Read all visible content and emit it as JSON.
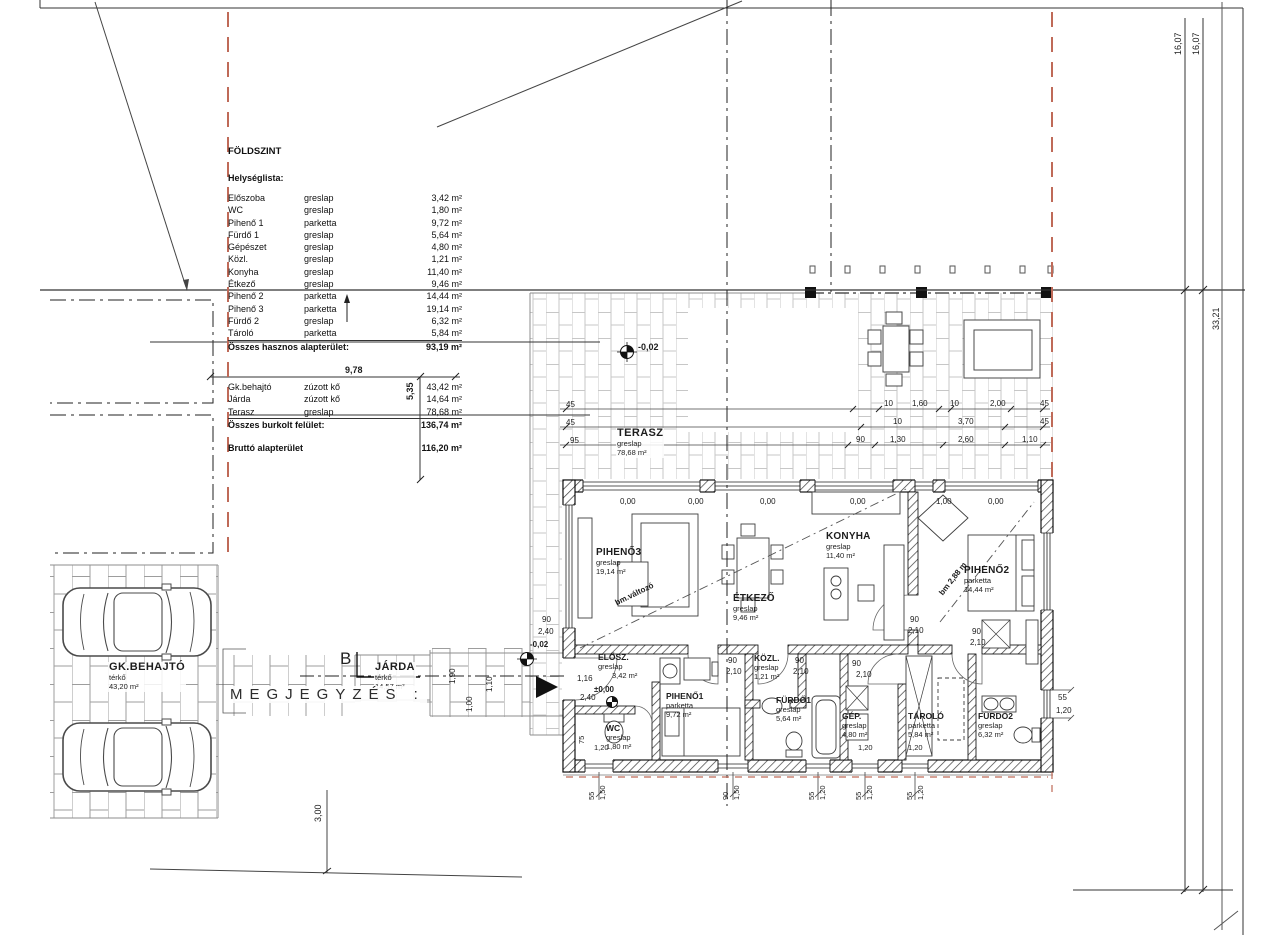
{
  "titleblock": {
    "title": "FÖLDSZINT",
    "list_heading": "Helységlista:",
    "rooms": [
      [
        "Előszoba",
        "greslap",
        "3,42 m²"
      ],
      [
        "WC",
        "greslap",
        "1,80 m²"
      ],
      [
        "Pihenő 1",
        "parketta",
        "9,72 m²"
      ],
      [
        "Fürdő 1",
        "greslap",
        "5,64 m²"
      ],
      [
        "Gépészet",
        "greslap",
        "4,80 m²"
      ],
      [
        "Közl.",
        "greslap",
        "1,21 m²"
      ],
      [
        "Konyha",
        "greslap",
        "11,40 m²"
      ],
      [
        "Étkező",
        "greslap",
        "9,46 m²"
      ],
      [
        "Pihenő 2",
        "parketta",
        "14,44 m²"
      ],
      [
        "Pihenő 3",
        "parketta",
        "19,14 m²"
      ],
      [
        "Fürdő 2",
        "greslap",
        "6,32 m²"
      ],
      [
        "Tároló",
        "parketta",
        "5,84 m²"
      ]
    ],
    "room_total_label": "Összes hasznos alapterület:",
    "room_total": "93,19 m²",
    "site_rows": [
      [
        "Gk.behajtó",
        "zúzott kő",
        "43,42 m²"
      ],
      [
        "Járda",
        "zúzott kő",
        "14,64 m²"
      ],
      [
        "Terasz",
        "greslap",
        "78,68 m²"
      ]
    ],
    "site_total_label": "Összes burkolt felület:",
    "site_total": "136,74 m²",
    "gross_label": "Bruttó alapterület",
    "gross_value": "116,20 m²"
  },
  "plan": {
    "pihen3": {
      "name": "PIHENŐ3",
      "finish": "greslap",
      "area": "19,14 m²"
    },
    "etkezo": {
      "name": "ÉTKEZŐ",
      "finish": "greslap",
      "area": "9,46 m²"
    },
    "konyha": {
      "name": "KONYHA",
      "finish": "greslap",
      "area": "11,40 m²"
    },
    "pihen2": {
      "name": "PIHENŐ2",
      "finish": "parketta",
      "area": "14,44 m²"
    },
    "elosz": {
      "name": "ELŐSZ.",
      "finish": "greslap",
      "area": "3,42 m²"
    },
    "wc": {
      "name": "WC",
      "finish": "greslap",
      "area": "1,80 m²"
    },
    "pihen1": {
      "name": "PIHENŐ1",
      "finish": "parketta",
      "area": "9,72 m²"
    },
    "kozl": {
      "name": "KÖZL.",
      "finish": "greslap",
      "area": "1,21 m²"
    },
    "furdo1": {
      "name": "FÜRDŐ1",
      "finish": "greslap",
      "area": "5,64 m²"
    },
    "gep": {
      "name": "GÉP.",
      "finish": "greslap",
      "area": "4,80 m²"
    },
    "tarolo": {
      "name": "TÁROLÓ",
      "finish": "parketta",
      "area": "5,84 m²"
    },
    "furdo2": {
      "name": "FÜRDŐ2",
      "finish": "greslap",
      "area": "6,32 m²"
    },
    "terasz": {
      "name": "TERASZ",
      "finish": "greslap",
      "area": "78,68 m²"
    },
    "gkbehajto": {
      "name": "GK.BEHAJTÓ",
      "finish": "térkő",
      "area": "43,20 m²"
    },
    "jarda": {
      "name": "JÁRDA",
      "finish": "térkő",
      "area": "14,57 m²"
    }
  },
  "annotations": {
    "megjegyzes": "MEGJEGYZÉS :",
    "section": "B",
    "bm1": "bm.változó",
    "bm2": "bm 2,88 m",
    "elev_terasz": "-0,02",
    "elev_kulso": "-0,02",
    "elev_belso": "±0,00"
  },
  "dims": {
    "d978": "9,78",
    "d535": "5,35",
    "d300": "3,00",
    "d1607": "16,07",
    "d3321": "33,21",
    "d45": "45",
    "d95": "95",
    "d10": "10",
    "d160": "1,60",
    "d200": "2,00",
    "d370": "3,70",
    "d90": "90",
    "d130": "1,30",
    "d260": "2,60",
    "d110": "1,10",
    "p000": "0,00",
    "p100": "1,00",
    "w190": "1,90",
    "w110": "1,10",
    "w100": "1,00",
    "door_w": "90",
    "door_h": "2,10",
    "entr_h": "2,40",
    "d116": "1,16",
    "d240": "2,40",
    "s55": "55",
    "s75": "75",
    "h120": "1,20",
    "h150": "1,50"
  }
}
